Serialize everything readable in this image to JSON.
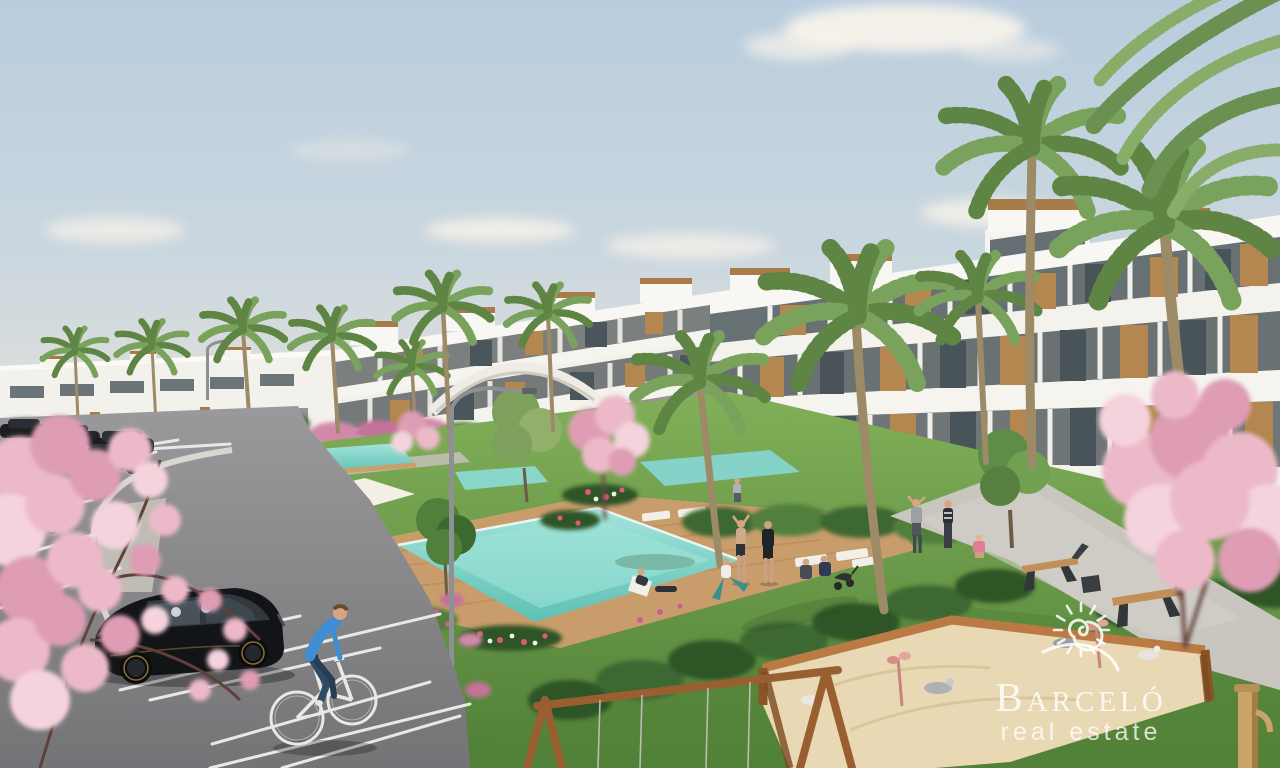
{
  "image": {
    "kind": "3D architectural rendering",
    "scene": "Modern white terraced apartment complex with communal pools, landscaped gardens, palm and cherry-blossom trees, surface parking with cars and a cyclist, and a children's playground with sandbox and swing frame"
  },
  "watermark": {
    "brand": "Barceló",
    "tagline": "real estate",
    "logo_icon": "sun-spiral-icon",
    "color": "#ffffff"
  },
  "palette": {
    "sky_top": "#b9cdde",
    "sky_horizon": "#eae7de",
    "building_white": "#f6f4ef",
    "wood_accent": "#b3874f",
    "terracotta": "#b5722f",
    "glass": "#5a646a",
    "lawn_light": "#82b059",
    "lawn_dark": "#4f7f37",
    "hedge": "#3d6830",
    "pool_water": "#7fd6c9",
    "deck_wood": "#c99d6b",
    "asphalt": "#8b8a8c",
    "blossom_pink": "#ecb9c9",
    "palm_green": "#5e8544",
    "sand": "#e8d9b4",
    "car_black": "#17181b",
    "cyclist_blue": "#3f8ed5"
  },
  "objects": [
    "apartment-buildings",
    "swimming-pools",
    "wood-deck",
    "sun-parasol",
    "sun-loungers",
    "palm-trees",
    "cherry-blossom-trees",
    "lawns",
    "hedges",
    "flower-beds",
    "parking-lot",
    "parking-lines",
    "parked-cars",
    "black-hatchback-car",
    "cyclist",
    "pedestrians",
    "exercise-group",
    "benches",
    "street-lamp",
    "pergola-arch",
    "swing-frame",
    "sandbox",
    "sand-toys",
    "wooden-post",
    "clouds"
  ]
}
